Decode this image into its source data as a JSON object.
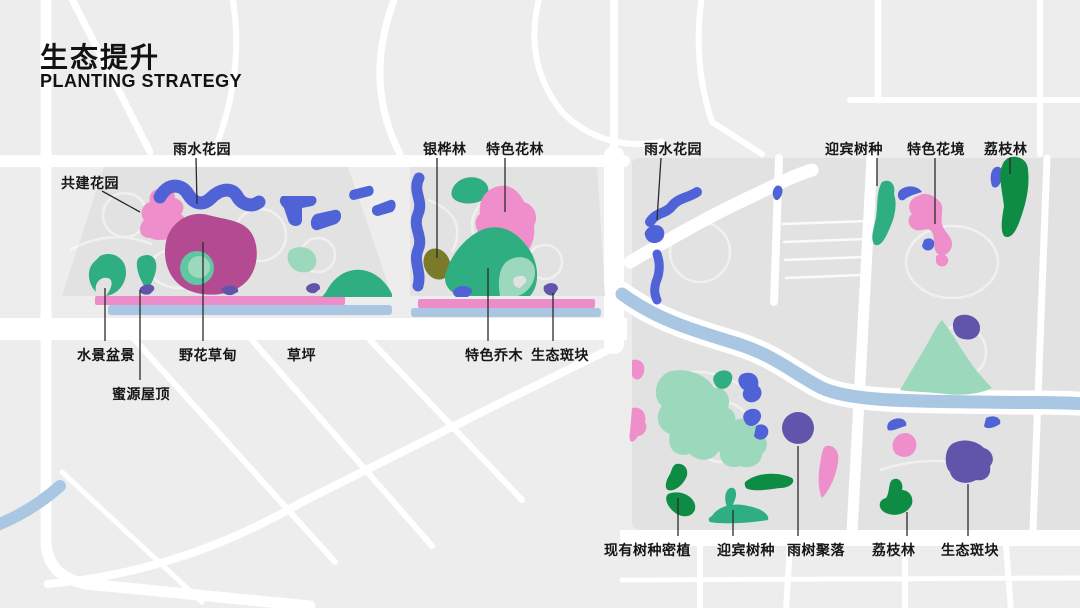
{
  "title": {
    "zh": "生态提升",
    "en": "PLANTING STRATEGY"
  },
  "palette": {
    "bg_gray": "#ededed",
    "map_gray": "#e2e2e2",
    "road_white": "#ffffff",
    "blue": "#4f63d6",
    "pink": "#ee8fcb",
    "magenta": "#b34a92",
    "mint": "#9cd9bc",
    "mint_dark": "#5fc7a1",
    "teal": "#2fae81",
    "green_dark": "#0e8c44",
    "olive": "#7b7a2b",
    "purple": "#6055ab",
    "strip_pink": "#ec8cc8",
    "water_blue": "#a9c6e2",
    "annotation_line": "#2b2b2b"
  },
  "maps": {
    "left": {
      "labels": {
        "rain_garden": "雨水花园",
        "co_built_garden": "共建花园",
        "water_feature_bonsai": "水景盆景",
        "wildflower_meadow": "野花草甸",
        "lawn": "草坪",
        "honey_source_roof": "蜜源屋顶"
      }
    },
    "middle": {
      "labels": {
        "silver_oak_forest": "银桦林",
        "special_flower_forest": "特色花林",
        "special_trees": "特色乔木",
        "eco_patch": "生态斑块"
      }
    },
    "right": {
      "labels": {
        "rain_garden": "雨水花园",
        "welcome_trees_top": "迎宾树种",
        "special_flower_border": "特色花境",
        "lychee_forest_top": "荔枝林",
        "existing_trees_dense": "现有树种密植",
        "welcome_trees_bottom": "迎宾树种",
        "rain_tree_cluster": "雨树聚落",
        "lychee_forest_bottom": "荔枝林",
        "eco_patch": "生态斑块"
      }
    }
  }
}
